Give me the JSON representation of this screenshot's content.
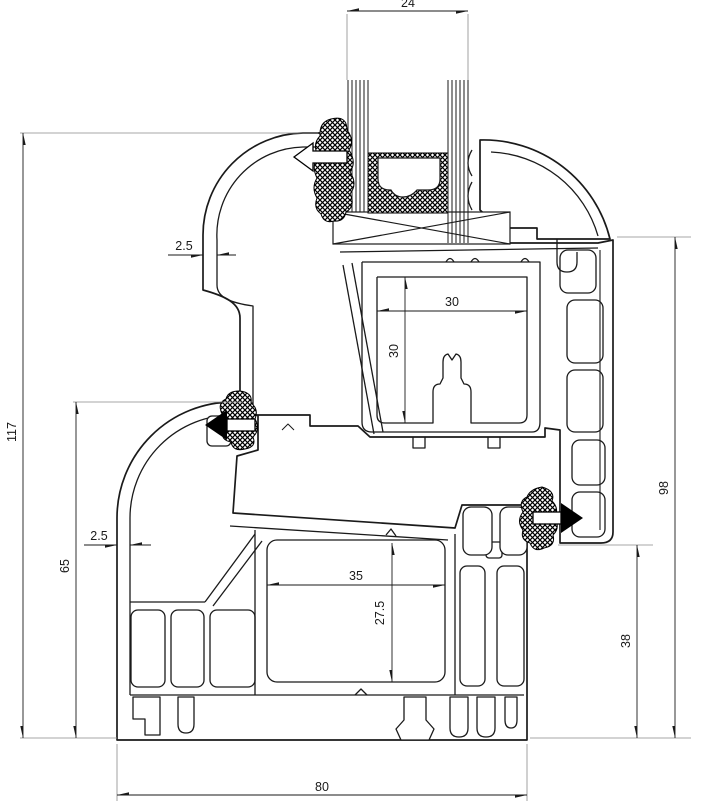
{
  "drawing": {
    "type": "technical-cross-section",
    "colors": {
      "line": "#1a1a1a",
      "background": "#ffffff",
      "extension_line": "#8a8a8a"
    },
    "dims": {
      "glass_width": "24",
      "overall_height": "117",
      "frame_height": "65",
      "sash_height": "98",
      "lower_right_height": "38",
      "frame_width": "80",
      "groove_width": "30",
      "groove_height": "30",
      "chamber_width": "35",
      "chamber_height": "27.5",
      "sash_wall_thickness": "2.5",
      "frame_wall_thickness": "2.5"
    }
  }
}
